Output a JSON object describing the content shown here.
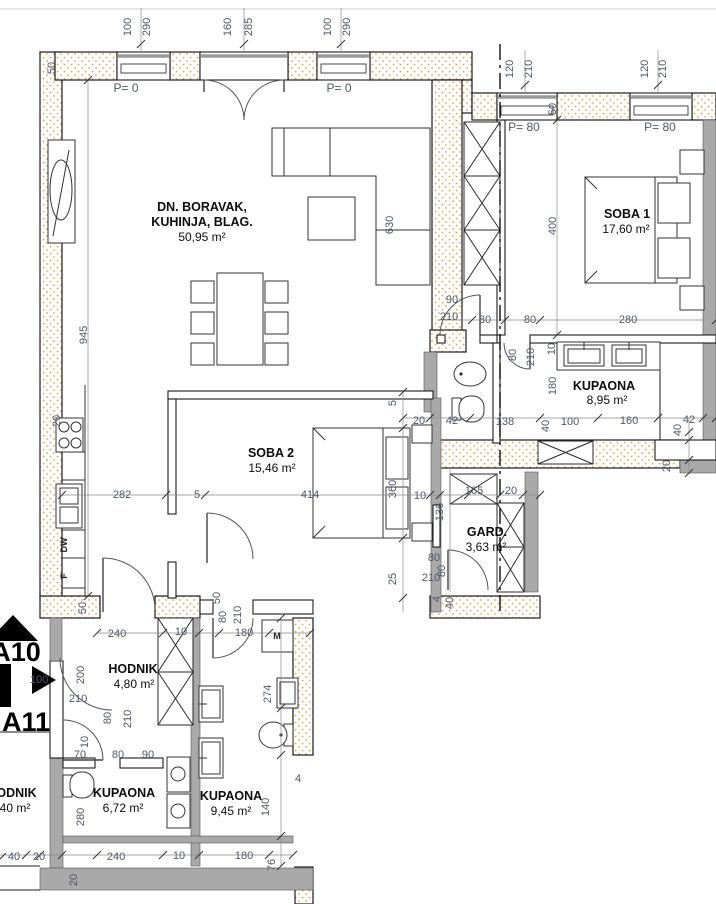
{
  "drawing": {
    "rooms": [
      {
        "name_line1": "DN. BORAVAK,",
        "name_line2": "KUHINJA, BLAG.",
        "area": "50,95 m²"
      },
      {
        "name_line1": "SOBA 1",
        "area": "17,60 m²"
      },
      {
        "name_line1": "KUPAONA",
        "area": "8,95 m²"
      },
      {
        "name_line1": "SOBA 2",
        "area": "15,46 m²"
      },
      {
        "name_line1": "GARD.",
        "area": "3,63 m²"
      },
      {
        "name_line1": "HODNIK",
        "area": "4,80 m²"
      },
      {
        "name_line1": "KUPAONA",
        "area": "6,72 m²"
      },
      {
        "name_line1": "KUPAONA",
        "area": "9,45 m²"
      },
      {
        "name_line1": "HODNIK",
        "area": "5,40 m²"
      }
    ],
    "section_markers": [
      {
        "label": "A10"
      },
      {
        "label": "A11"
      }
    ],
    "window_labels": [
      {
        "t": "P= 0",
        "x": 126,
        "y": 92
      },
      {
        "t": "P= 0",
        "x": 339,
        "y": 92
      },
      {
        "t": "P= 80",
        "x": 524,
        "y": 131
      },
      {
        "t": "P= 80",
        "x": 660,
        "y": 131
      }
    ],
    "fixture_labels": [
      {
        "t": "DW",
        "x": 67,
        "y": 545,
        "r": -90
      },
      {
        "t": "F",
        "x": 67,
        "y": 576,
        "r": -90
      },
      {
        "t": "M",
        "x": 277,
        "y": 639,
        "r": 0
      }
    ],
    "dimensions": [
      {
        "t": "100",
        "x": 131,
        "y": 27,
        "r": -90
      },
      {
        "t": "290",
        "x": 150,
        "y": 27,
        "r": -90
      },
      {
        "t": "160",
        "x": 231,
        "y": 27,
        "r": -90
      },
      {
        "t": "285",
        "x": 252,
        "y": 27,
        "r": -90
      },
      {
        "t": "100",
        "x": 331,
        "y": 27,
        "r": -90
      },
      {
        "t": "290",
        "x": 350,
        "y": 27,
        "r": -90
      },
      {
        "t": "50",
        "x": 55,
        "y": 68,
        "r": -90
      },
      {
        "t": "120",
        "x": 513,
        "y": 69,
        "r": -90
      },
      {
        "t": "210",
        "x": 532,
        "y": 69,
        "r": -90
      },
      {
        "t": "120",
        "x": 648,
        "y": 69,
        "r": -90
      },
      {
        "t": "210",
        "x": 666,
        "y": 69,
        "r": -90
      },
      {
        "t": "50",
        "x": 556,
        "y": 109,
        "r": -90
      },
      {
        "t": "945",
        "x": 87,
        "y": 335,
        "r": -90
      },
      {
        "t": "630",
        "x": 393,
        "y": 225,
        "r": -90
      },
      {
        "t": "20",
        "x": 60,
        "y": 421,
        "r": -90
      },
      {
        "t": "282",
        "x": 122,
        "y": 498,
        "r": 0
      },
      {
        "t": "5",
        "x": 197,
        "y": 498,
        "r": 0
      },
      {
        "t": "414",
        "x": 310,
        "y": 498,
        "r": 0
      },
      {
        "t": "360",
        "x": 396,
        "y": 489,
        "r": -90
      },
      {
        "t": "10",
        "x": 420,
        "y": 499,
        "r": 0
      },
      {
        "t": "136",
        "x": 443,
        "y": 512,
        "r": -90
      },
      {
        "t": "165",
        "x": 474,
        "y": 494,
        "r": 0
      },
      {
        "t": "20",
        "x": 511,
        "y": 494,
        "r": 0
      },
      {
        "t": "5",
        "x": 396,
        "y": 403,
        "r": -90
      },
      {
        "t": "20",
        "x": 419,
        "y": 424,
        "r": 0
      },
      {
        "t": "42",
        "x": 452,
        "y": 424,
        "r": 0
      },
      {
        "t": "90",
        "x": 452,
        "y": 303,
        "r": 0
      },
      {
        "t": "210",
        "x": 449,
        "y": 320,
        "r": 0
      },
      {
        "t": "80",
        "x": 485,
        "y": 323,
        "r": 0
      },
      {
        "t": "80",
        "x": 530,
        "y": 323,
        "r": 0
      },
      {
        "t": "280",
        "x": 628,
        "y": 323,
        "r": 0
      },
      {
        "t": "400",
        "x": 556,
        "y": 226,
        "r": -90
      },
      {
        "t": "80",
        "x": 516,
        "y": 355,
        "r": -90
      },
      {
        "t": "210",
        "x": 534,
        "y": 357,
        "r": -90
      },
      {
        "t": "10",
        "x": 555,
        "y": 349,
        "r": -90
      },
      {
        "t": "180",
        "x": 556,
        "y": 386,
        "r": -90
      },
      {
        "t": "40",
        "x": 549,
        "y": 426,
        "r": -90
      },
      {
        "t": "138",
        "x": 505,
        "y": 425,
        "r": 0
      },
      {
        "t": "100",
        "x": 570,
        "y": 425,
        "r": 0
      },
      {
        "t": "160",
        "x": 629,
        "y": 424,
        "r": 0
      },
      {
        "t": "42",
        "x": 689,
        "y": 423,
        "r": 0
      },
      {
        "t": "40",
        "x": 681,
        "y": 430,
        "r": -90
      },
      {
        "t": "20",
        "x": 670,
        "y": 466,
        "r": -90
      },
      {
        "t": "80",
        "x": 434,
        "y": 561,
        "r": 0
      },
      {
        "t": "80",
        "x": 445,
        "y": 571,
        "r": -90
      },
      {
        "t": "210",
        "x": 431,
        "y": 581,
        "r": 0
      },
      {
        "t": "25",
        "x": 396,
        "y": 579,
        "r": -90
      },
      {
        "t": "4",
        "x": 440,
        "y": 599,
        "r": -90
      },
      {
        "t": "40",
        "x": 453,
        "y": 603,
        "r": -90
      },
      {
        "t": "50",
        "x": 220,
        "y": 598,
        "r": -90
      },
      {
        "t": "50",
        "x": 86,
        "y": 608,
        "r": -90
      },
      {
        "t": "240",
        "x": 117,
        "y": 637,
        "r": 0
      },
      {
        "t": "10",
        "x": 181,
        "y": 635,
        "r": 0
      },
      {
        "t": "80",
        "x": 226,
        "y": 617,
        "r": -90
      },
      {
        "t": "210",
        "x": 241,
        "y": 615,
        "r": -90
      },
      {
        "t": "180",
        "x": 244,
        "y": 636,
        "r": 0
      },
      {
        "t": "100",
        "x": 39,
        "y": 683,
        "r": 0
      },
      {
        "t": "210",
        "x": 78,
        "y": 702,
        "r": 0
      },
      {
        "t": "200",
        "x": 84,
        "y": 675,
        "r": -90
      },
      {
        "t": "80",
        "x": 111,
        "y": 718,
        "r": -90
      },
      {
        "t": "210",
        "x": 131,
        "y": 719,
        "r": -90
      },
      {
        "t": "70",
        "x": 80,
        "y": 758,
        "r": 0
      },
      {
        "t": "10",
        "x": 88,
        "y": 742,
        "r": -90
      },
      {
        "t": "80",
        "x": 118,
        "y": 758,
        "r": 0
      },
      {
        "t": "90",
        "x": 148,
        "y": 758,
        "r": 0
      },
      {
        "t": "280",
        "x": 84,
        "y": 817,
        "r": -90
      },
      {
        "t": "274",
        "x": 271,
        "y": 694,
        "r": -90
      },
      {
        "t": "140",
        "x": 269,
        "y": 807,
        "r": -90
      },
      {
        "t": "4",
        "x": 298,
        "y": 782,
        "r": 0
      },
      {
        "t": "240",
        "x": 116,
        "y": 860,
        "r": 0
      },
      {
        "t": "10",
        "x": 179,
        "y": 859,
        "r": 0
      },
      {
        "t": "180",
        "x": 244,
        "y": 859,
        "r": 0
      },
      {
        "t": "76",
        "x": 275,
        "y": 865,
        "r": -90
      },
      {
        "t": "20",
        "x": 77,
        "y": 880,
        "r": -90
      },
      {
        "t": "40",
        "x": 14,
        "y": 860,
        "r": 0
      },
      {
        "t": "20",
        "x": 39,
        "y": 860,
        "r": 0
      }
    ]
  }
}
